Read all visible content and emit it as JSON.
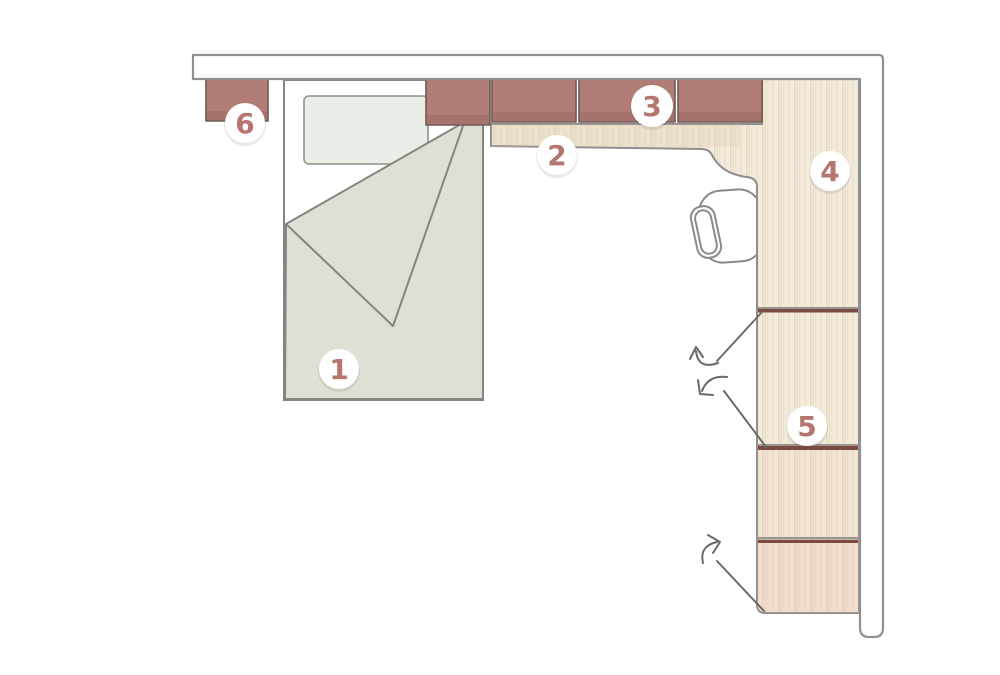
{
  "diagram": {
    "kind": "bedroom-floor-plan",
    "badges": [
      {
        "label": "1"
      },
      {
        "label": "2"
      },
      {
        "label": "3"
      },
      {
        "label": "4"
      },
      {
        "label": "5"
      },
      {
        "label": "6"
      }
    ],
    "colors": {
      "floor": "#ffffff",
      "wall_fill": "#ffffff",
      "wall_stroke": "#909090",
      "outline": "#85857f",
      "cabinet": "#b17d76",
      "cabinet_dark": "#96655e",
      "cabinet_stroke": "#6e5a55",
      "wood": "#f3ebdb",
      "wood_grain": "#e3d3b6",
      "wood_stroke": "#8f8f8e",
      "divider": "#7d4a41",
      "divider_gray": "#9a948f",
      "blanket": "#e0dfd5",
      "pillow": "#e9eee7",
      "pillow_stroke": "#97a097",
      "chair_stroke": "#8a8a8a",
      "arrow": "#6a6a6a",
      "badge_fill": "#ffffff",
      "badge_text": "#b5766f"
    }
  }
}
